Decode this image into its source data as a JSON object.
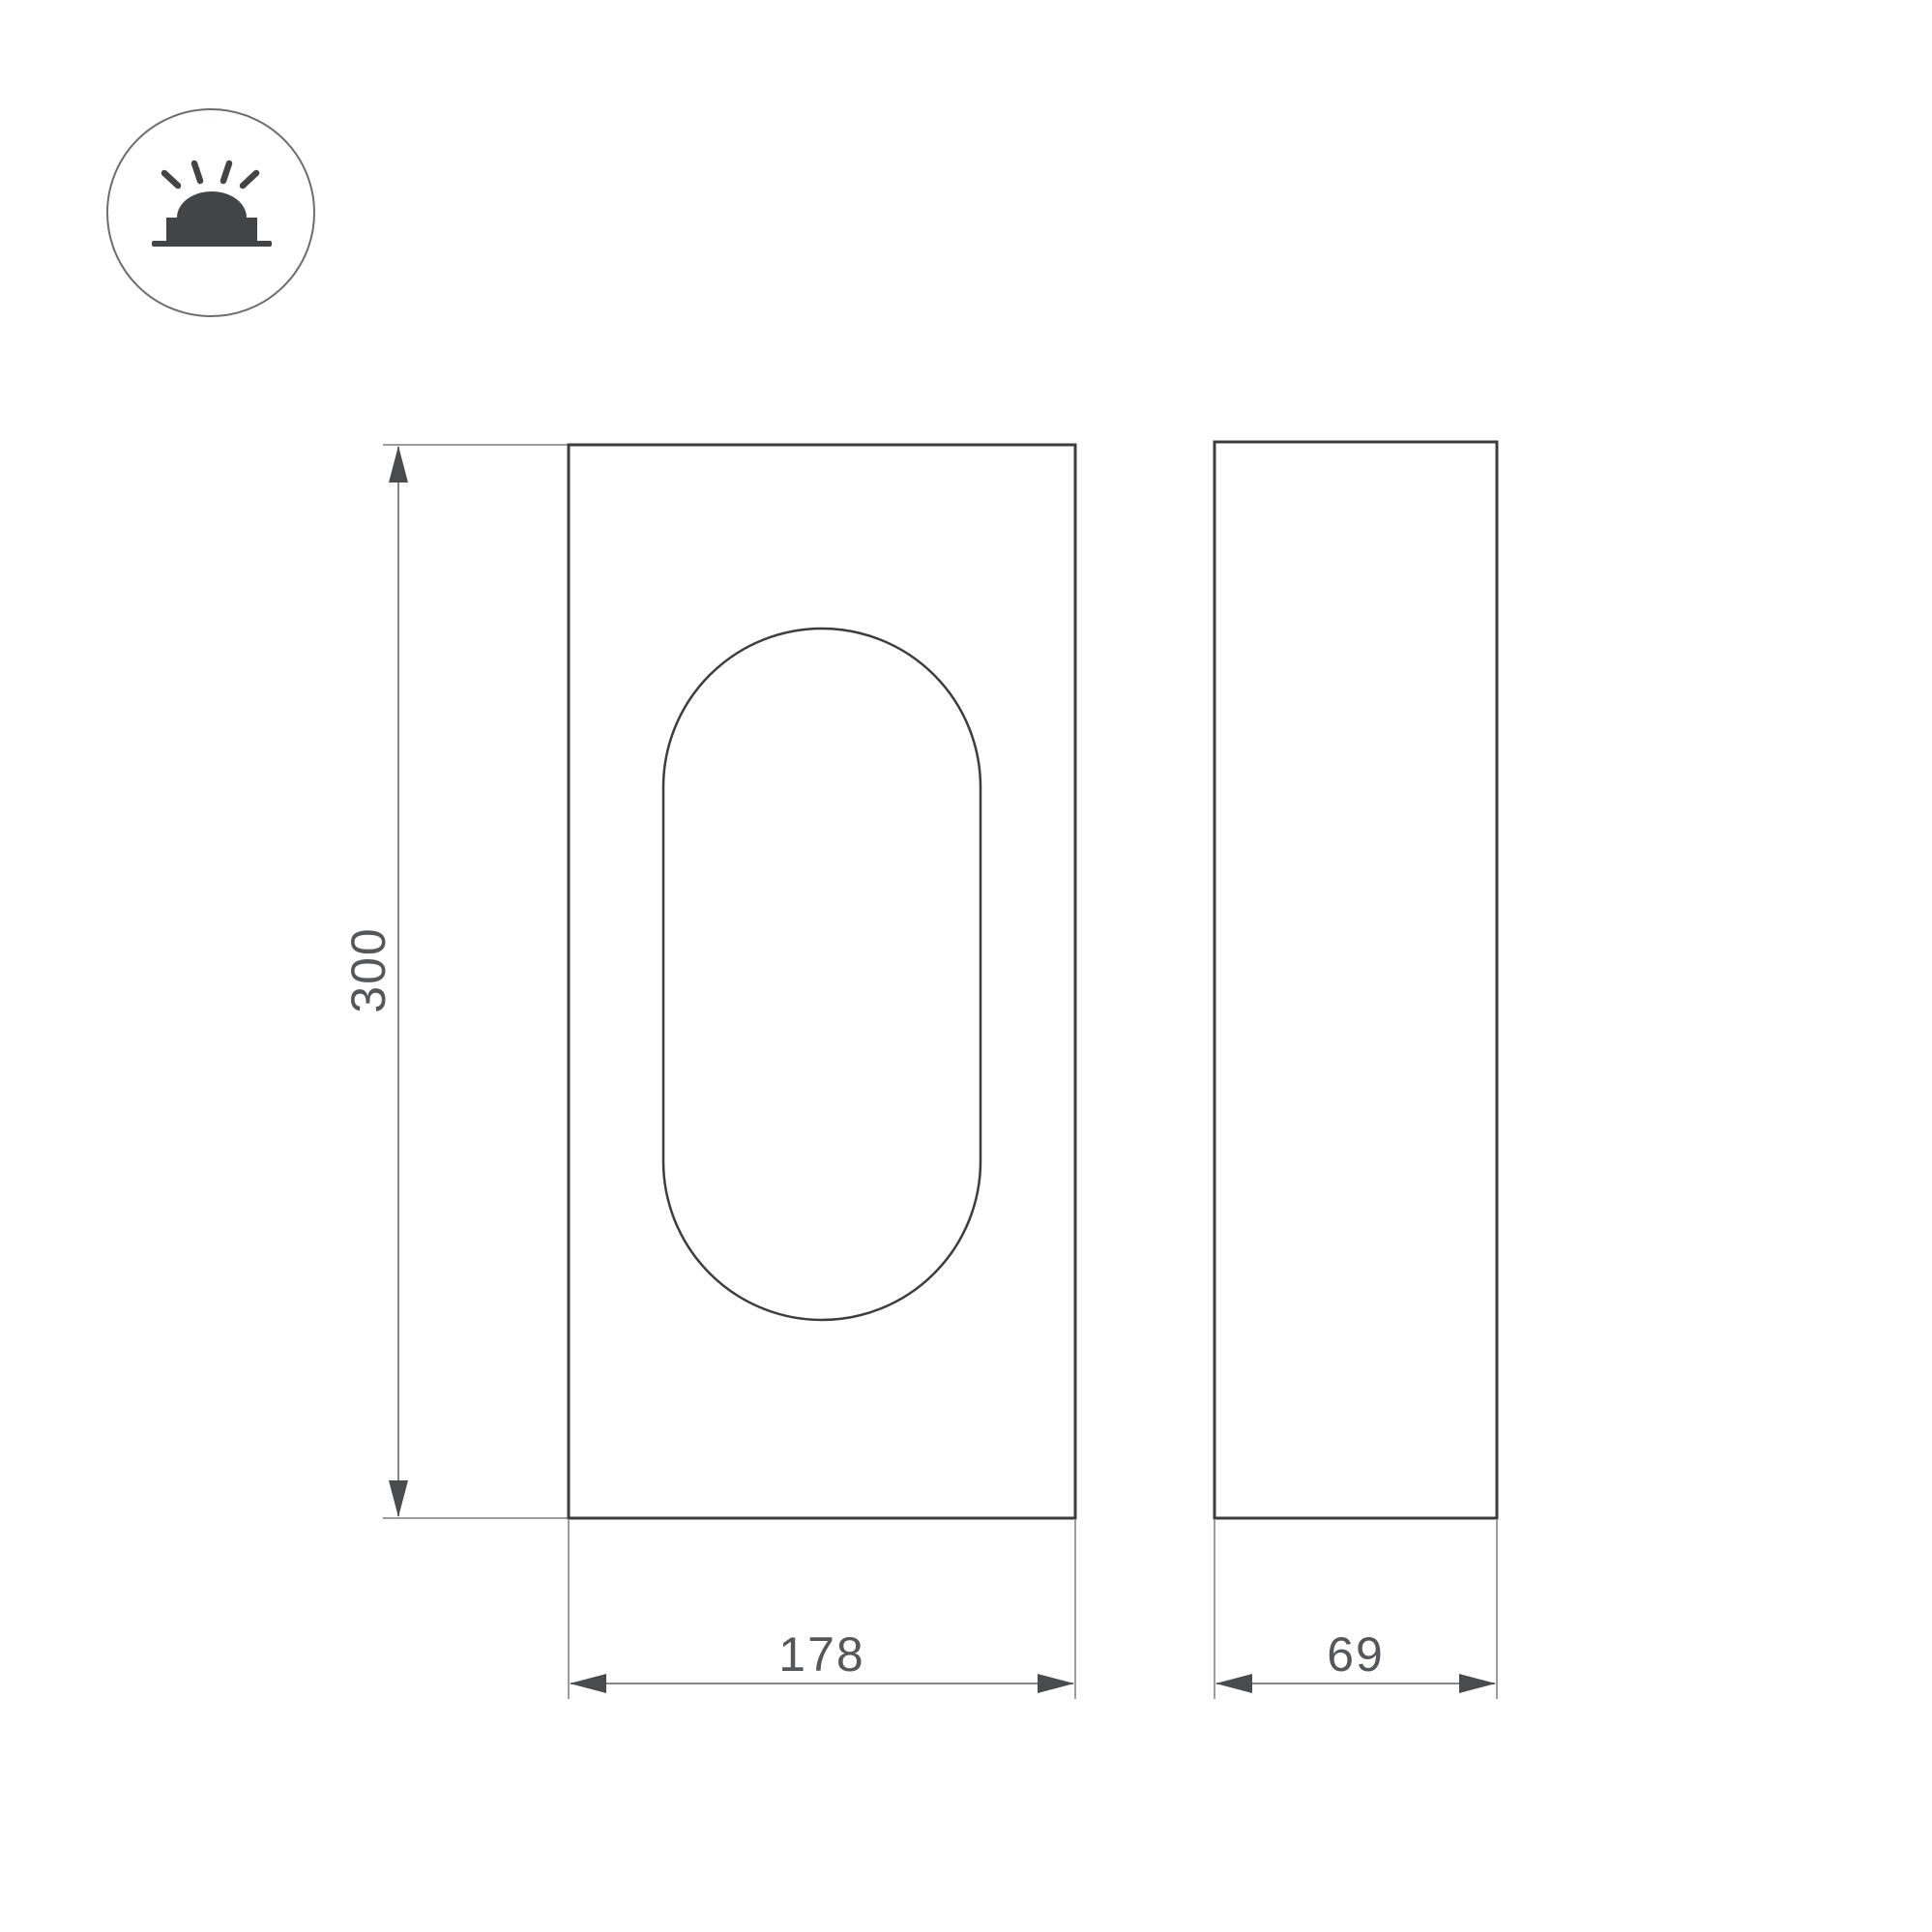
{
  "colors": {
    "background": "#ffffff",
    "object_line": "#3b3d3f",
    "lens_line": "#3b3d3f",
    "dim_line": "#85878a",
    "ext_line": "#9b9da0",
    "arrow": "#494b4d",
    "dim_text": "#55575a",
    "icon": "#424446",
    "badge_ring": "#6b6e70",
    "badge_fill": "#ffffff"
  },
  "badge": {
    "icon_name": "surface-mounted-light-icon"
  },
  "views": {
    "front": {
      "name": "front-view"
    },
    "side": {
      "name": "side-view"
    }
  },
  "dimensions": {
    "height": {
      "value": "300"
    },
    "width": {
      "value": "178"
    },
    "depth": {
      "value": "69"
    }
  }
}
